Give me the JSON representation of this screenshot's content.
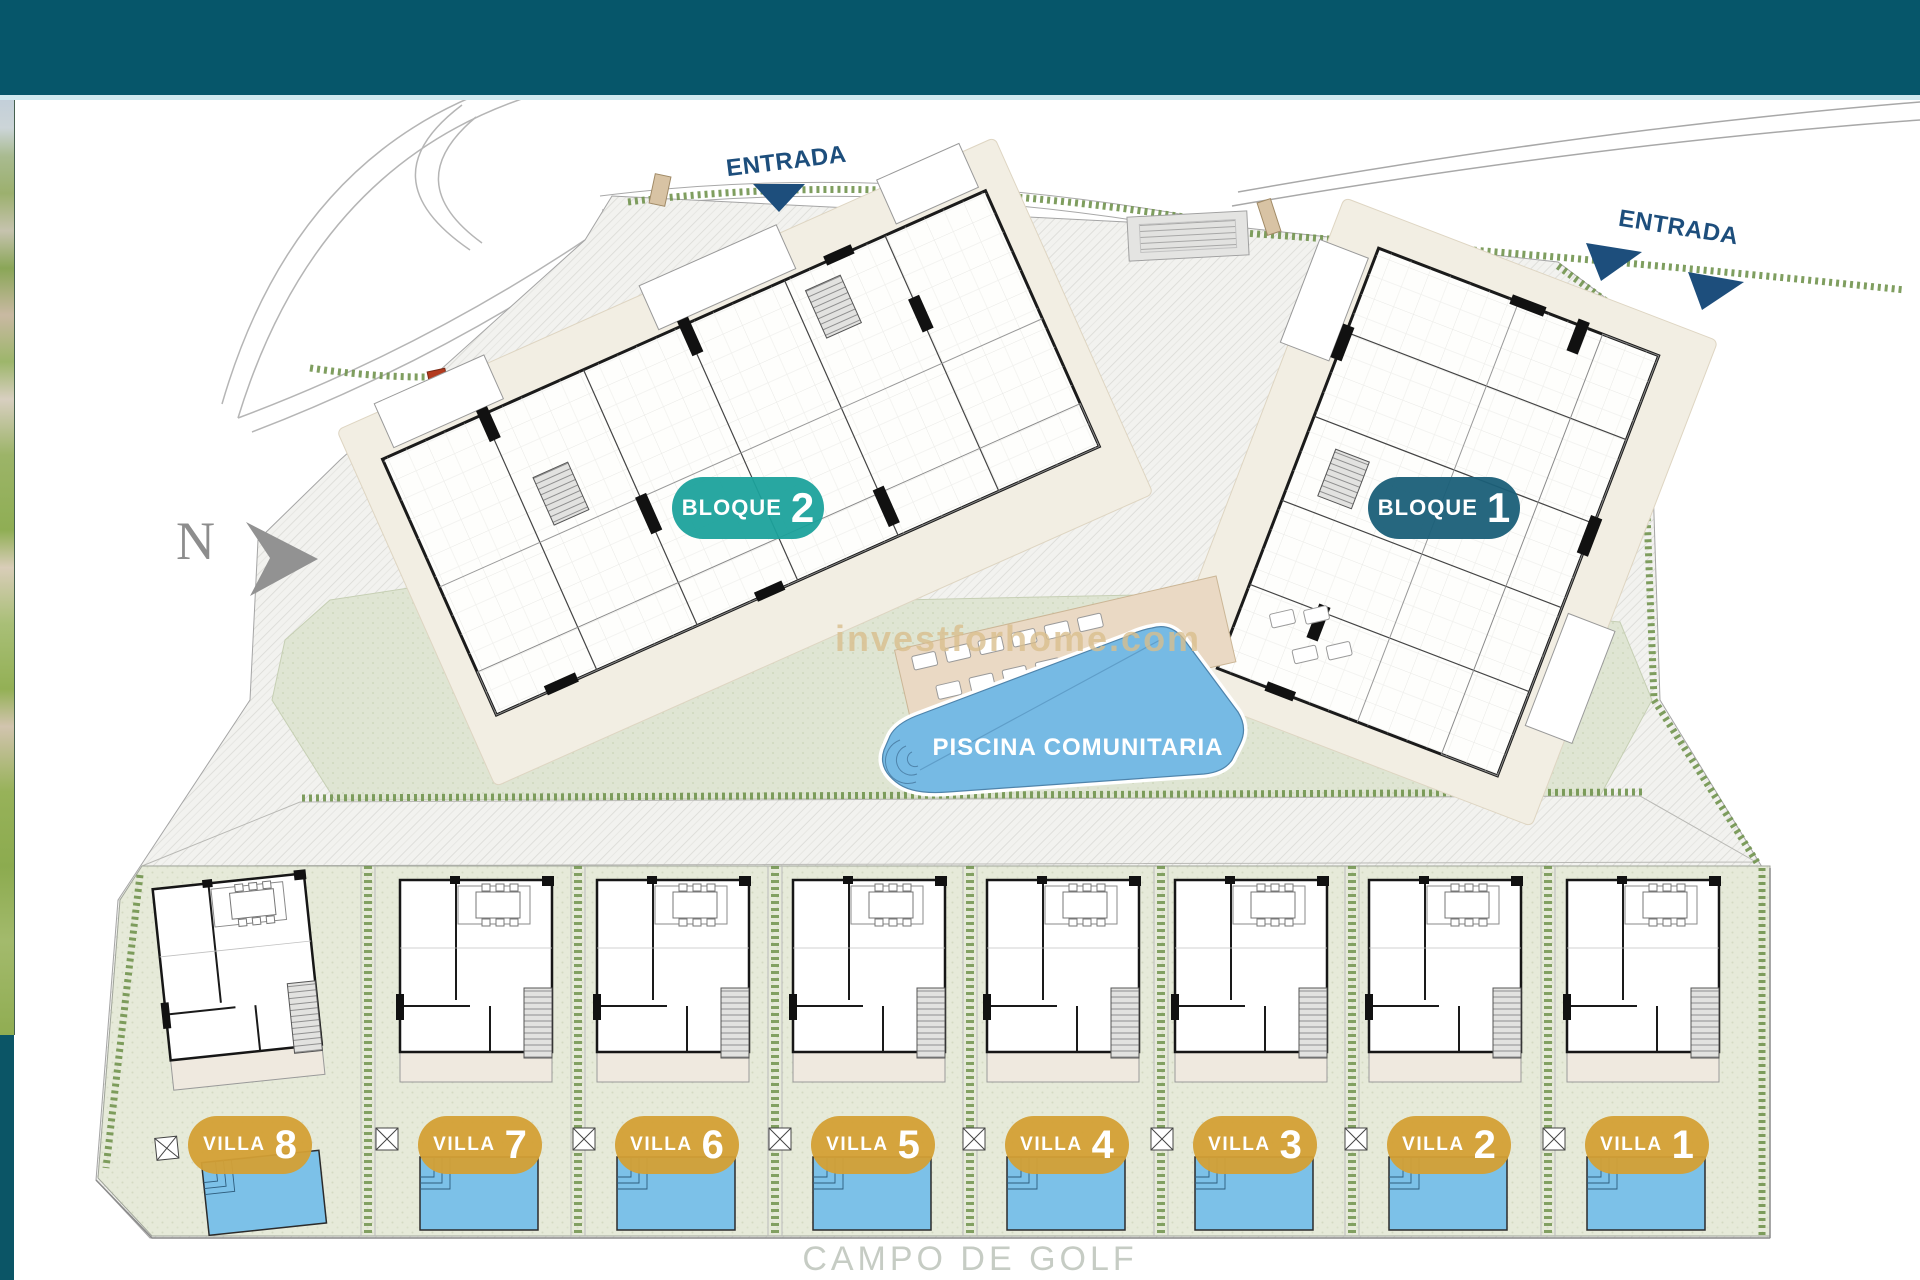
{
  "header": {
    "bar_color": "#06566a"
  },
  "north_indicator": {
    "label": "N"
  },
  "entrances": {
    "top": {
      "label": "ENTRADA"
    },
    "right": {
      "label": "ENTRADA"
    }
  },
  "blocks": [
    {
      "label": "BLOQUE",
      "number": "2",
      "badge_color": "#1ba29b"
    },
    {
      "label": "BLOQUE",
      "number": "1",
      "badge_color": "#1a5f78"
    }
  ],
  "pool": {
    "label": "PISCINA COMUNITARIA",
    "water_color": "#76bae4"
  },
  "villas": [
    {
      "label": "VILLA",
      "number": "8"
    },
    {
      "label": "VILLA",
      "number": "7"
    },
    {
      "label": "VILLA",
      "number": "6"
    },
    {
      "label": "VILLA",
      "number": "5"
    },
    {
      "label": "VILLA",
      "number": "4"
    },
    {
      "label": "VILLA",
      "number": "3"
    },
    {
      "label": "VILLA",
      "number": "2"
    },
    {
      "label": "VILLA",
      "number": "1"
    }
  ],
  "watermark": {
    "text": "investforhome.com"
  },
  "golf_area": {
    "label": "CAMPO DE GOLF"
  },
  "colors": {
    "header_teal": "#06566a",
    "bloque2_teal": "#1ba29b",
    "bloque1_petrol": "#1a5f78",
    "villa_gold": "#d4a035",
    "pool_blue": "#76bae4",
    "villa_pool_blue": "#7cc1e8",
    "hedge_green": "#71944e",
    "entrance_navy": "#1d4e7c"
  }
}
